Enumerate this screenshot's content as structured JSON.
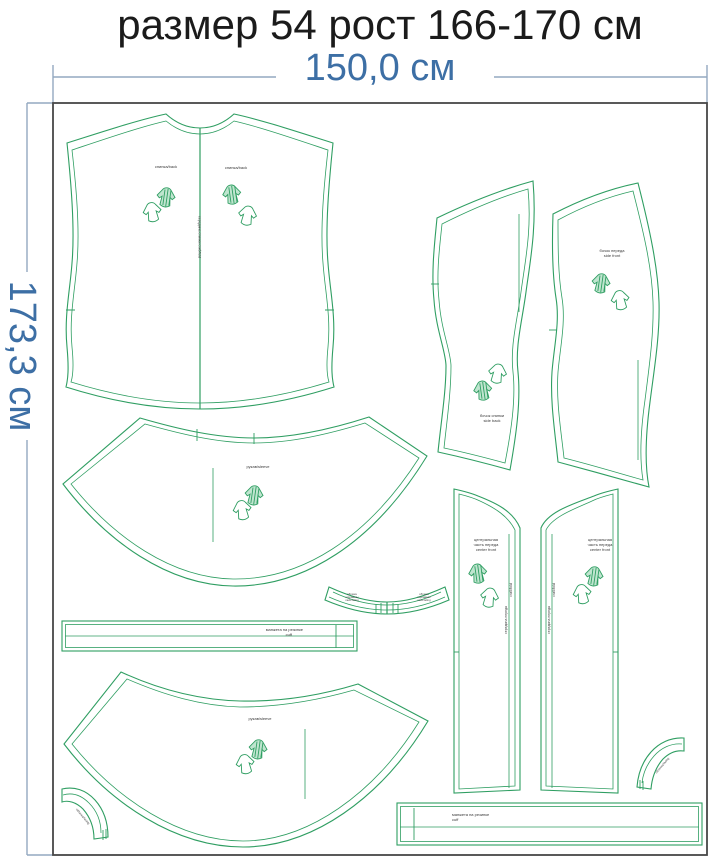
{
  "title": "размер 54 рост 166-170 см",
  "dimensions": {
    "width": "150,0 см",
    "height": "173,3 см"
  },
  "colors": {
    "pattern_green": "#2f9e62",
    "dimension_blue": "#3d6fa5",
    "dimension_line": "#93a9c0",
    "frame_gray": "#474747",
    "label_gray": "#3a3a3a"
  },
  "pieces": {
    "back": {
      "label_left": "спинка/back",
      "label_right": "спинка/back",
      "fold_text": "середина спинки сгиб/fold"
    },
    "sleeve_top": {
      "label": "рукав/sleeve"
    },
    "sleeve_bottom": {
      "label": "рукав/sleeve"
    },
    "side_back": {
      "lines": [
        "бочок спинки",
        "side back"
      ]
    },
    "side_front": {
      "lines": [
        "бочок переда",
        "side front"
      ]
    },
    "front_left": {
      "lines": [
        "центральная",
        "часть переда",
        "center front"
      ],
      "vtext1": "середина переда",
      "vtext2": "сгиб/fold"
    },
    "front_right": {
      "lines": [
        "центральная",
        "часть переда",
        "center front"
      ],
      "vtext1": "середина переда",
      "vtext2": "сгиб/fold"
    },
    "neckband": {
      "end_left": [
        "обтачка",
        "горловины",
        "neck facing"
      ],
      "end_right": [
        "обтачка",
        "горловины",
        "neck facing"
      ]
    },
    "cuff_left": {
      "lines": [
        "манжета на резинке",
        "cuff"
      ]
    },
    "cuff_bottom": {
      "lines": [
        "манжета на резинке",
        "cuff"
      ]
    },
    "band_bottom_left": {
      "label": "обтачка/facing"
    },
    "band_bottom_right": {
      "label": "обтачка/facing"
    }
  }
}
